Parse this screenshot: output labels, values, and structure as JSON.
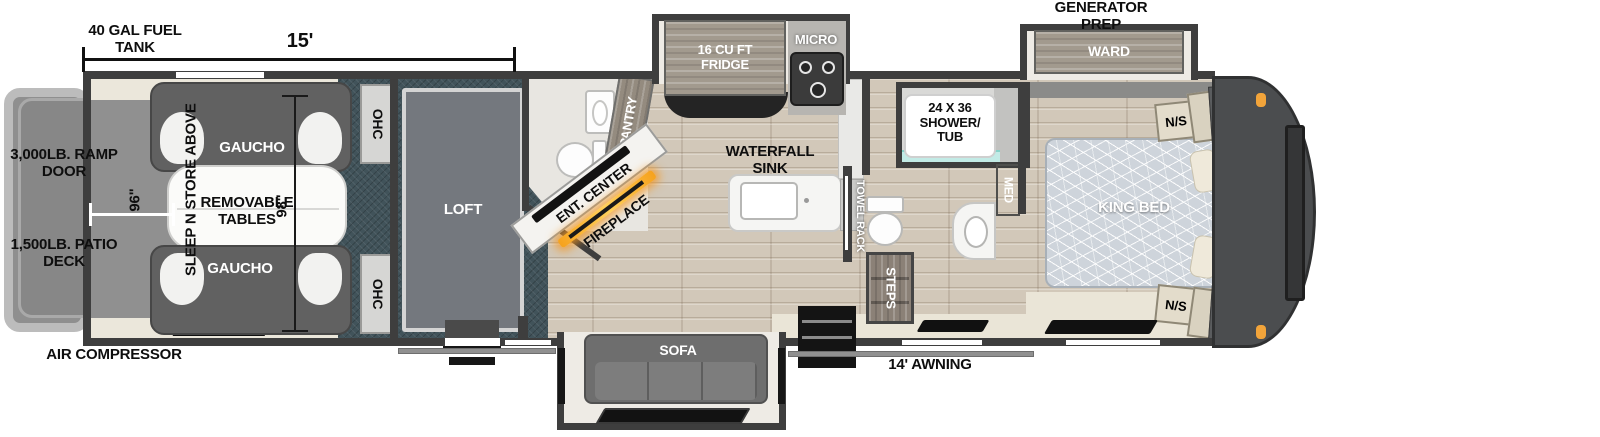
{
  "dims": {
    "fuel_tank": "40 GAL FUEL TANK",
    "length": "15'",
    "width_in": "96\"",
    "depth_in": "98\"",
    "awning": "14' AWNING"
  },
  "exterior": {
    "generator_prep": "GENERATOR PREP",
    "ramp_door": "3,000LB. RAMP DOOR",
    "patio_deck": "1,500LB. PATIO DECK",
    "air_compressor": "AIR COMPRESSOR"
  },
  "garage": {
    "gaucho_top": "GAUCHO",
    "gaucho_bottom": "GAUCHO",
    "tables": "REMOVABLE TABLES",
    "sleep_n_store": "SLEEP N STORE ABOVE",
    "ohc_top": "OHC",
    "ohc_bottom": "OHC",
    "loft": "LOFT"
  },
  "kitchen": {
    "fridge": "16 CU FT FRIDGE",
    "micro": "MICRO",
    "pantry": "PANTRY",
    "ent_center": "ENT. CENTER",
    "fireplace": "FIREPLACE",
    "waterfall_sink": "WATERFALL SINK",
    "sofa": "SOFA"
  },
  "bath": {
    "shower_l1": "24 X 36",
    "shower_l2": "SHOWER/",
    "shower_l3": "TUB",
    "towel_rack": "TOWEL RACK",
    "med": "MED",
    "steps": "STEPS"
  },
  "bedroom": {
    "ward_slide": "WARD",
    "ns_top": "N/S",
    "ns_bottom": "N/S",
    "ward_top": "WARD",
    "ward_bottom": "WARD",
    "king_bed": "KING BED",
    "shelf": "SHELF"
  },
  "colors": {
    "wall": "#3e3e3e",
    "teal_floor": "#41535a",
    "wood_floor": "#d2c8b9",
    "garage_floor": "#909090",
    "marker_light": "#f2a43a",
    "fireplace_glow": "#f6a21e",
    "water": "#c2ebe6"
  }
}
